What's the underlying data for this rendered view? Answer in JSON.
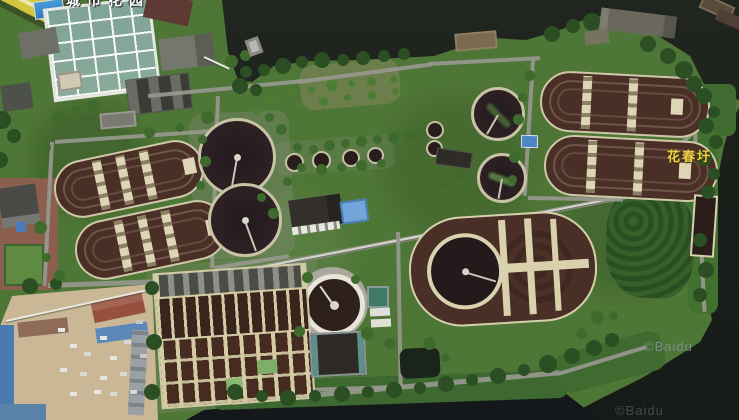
{
  "map": {
    "view": "satellite",
    "place_label": "花春圩",
    "top_label_partial": "城市花园",
    "watermark_primary": "©Baidu",
    "watermark_secondary": "©Baidu"
  },
  "colors": {
    "water": "#1d211d",
    "vegetation": "#4e7636",
    "tank_water": "#482e25",
    "clarifier_dark": "#261b1e",
    "walkway_tan": "#d6cfaa",
    "place_label_yellow": "#f0d04a",
    "watermark_gray": "#8a949e"
  }
}
